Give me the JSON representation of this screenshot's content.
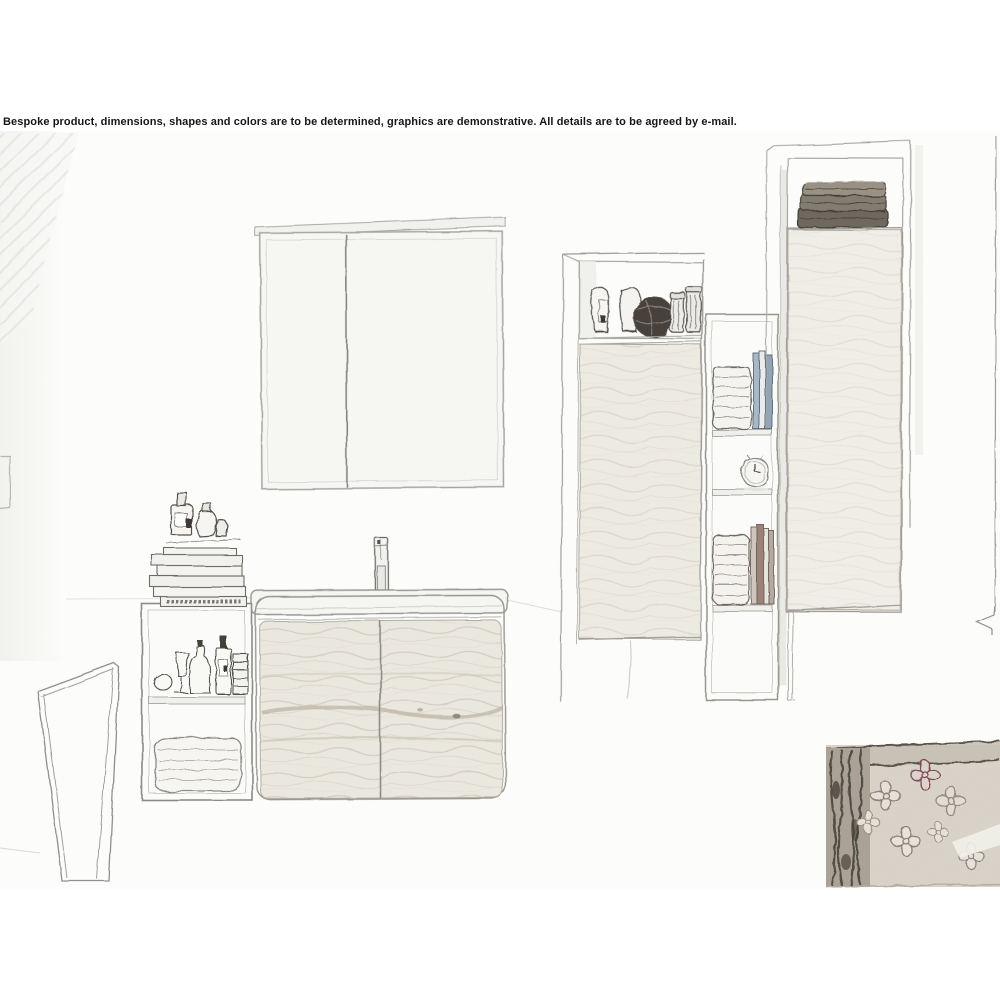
{
  "window": {
    "width": 1000,
    "height": 1000,
    "background": "#ffffff"
  },
  "disclaimer": {
    "text": "Bespoke product, dimensions, shapes and colors are to be determined, graphics are demonstrative. All details are to be agreed by e-mail."
  },
  "scene": {
    "alt": "Hand-drawn pencil sketch of a bathroom furniture set",
    "objects": [
      {
        "id": "mirror-cabinet",
        "label": "Two-door mirror cabinet"
      },
      {
        "id": "washbasin-vanity",
        "label": "Two-door washbasin vanity with wood-grain front"
      },
      {
        "id": "faucet",
        "label": "Tall basin mixer tap"
      },
      {
        "id": "side-shelf-unit",
        "label": "Open side shelf with toiletries and folded towels"
      },
      {
        "id": "books-and-perfume",
        "label": "Stack of books with perfume bottles on top"
      },
      {
        "id": "tall-cabinet-middle",
        "label": "Tall cabinet with open niche holding vases, jars and a rattan ball"
      },
      {
        "id": "open-shelf-column",
        "label": "Narrow shelf column with towels, books and an alarm clock"
      },
      {
        "id": "alarm-clock",
        "label": "Round alarm clock"
      },
      {
        "id": "tall-cabinet-right",
        "label": "Tall cabinet with stacked dark towels in top niche"
      },
      {
        "id": "open-door",
        "label": "Open door leaf at lower left"
      },
      {
        "id": "carved-panel",
        "label": "Carved floral panel in lower right corner"
      }
    ],
    "colors": {
      "paper": "#ffffff",
      "sketch_line": "#9b9b97",
      "detail_line": "#55514c",
      "wood_fill": "#eae7de",
      "wood_grain": "#c9c2b2",
      "dark_towels": "#6e675e",
      "book_blue": "#a9b8c6",
      "book_red": "#9d8078",
      "panel_base": "#d8d2c8",
      "panel_dark": "#4a443c"
    }
  }
}
